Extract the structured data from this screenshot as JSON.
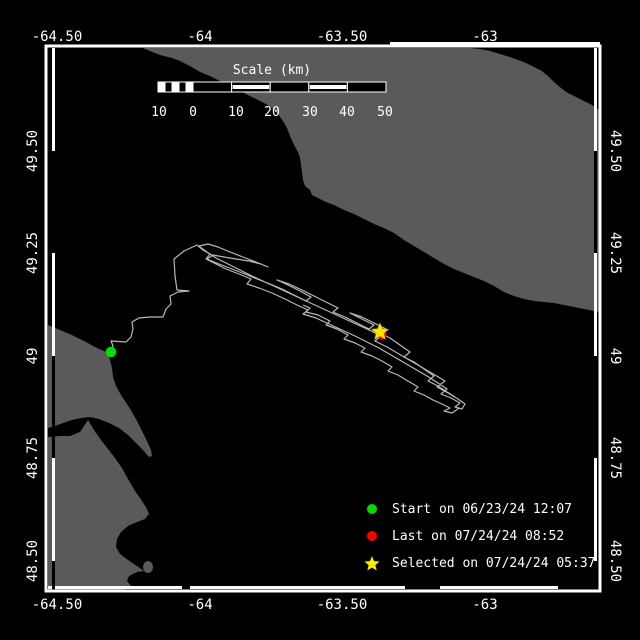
{
  "window": {
    "title": "Track map viewer"
  },
  "colors": {
    "background": "#000000",
    "water": "#000000",
    "land": "#5a5a5a",
    "border": "#ffffff",
    "track": "#b8b8b8",
    "start_marker": "#00dd00",
    "last_marker": "#ff0000",
    "selected_marker": "#ffe600",
    "text": "#ffffff"
  },
  "axis": {
    "top": [
      {
        "text": "-64.50",
        "x": 57
      },
      {
        "text": "-64",
        "x": 200
      },
      {
        "text": "-63.50",
        "x": 342
      },
      {
        "text": "-63",
        "x": 485
      }
    ],
    "bottom": [
      {
        "text": "-64.50",
        "x": 57
      },
      {
        "text": "-64",
        "x": 200
      },
      {
        "text": "-63.50",
        "x": 342
      },
      {
        "text": "-63",
        "x": 485
      }
    ],
    "left": [
      {
        "text": "49.50",
        "y": 151
      },
      {
        "text": "49.25",
        "y": 253
      },
      {
        "text": "49",
        "y": 356
      },
      {
        "text": "48.75",
        "y": 458
      },
      {
        "text": "48.50",
        "y": 561
      }
    ],
    "right": [
      {
        "text": "49.50",
        "y": 151
      },
      {
        "text": "49.25",
        "y": 253
      },
      {
        "text": "49",
        "y": 356
      },
      {
        "text": "48.75",
        "y": 458
      },
      {
        "text": "48.50",
        "y": 561
      }
    ]
  },
  "scalebar": {
    "title": "Scale (km)",
    "title_x": 272,
    "title_y": 74,
    "x1": 158,
    "zero_x": 193,
    "x2": 386,
    "y1": 82,
    "y2": 92,
    "label_y": 116,
    "labels": [
      {
        "text": "10",
        "x": 159
      },
      {
        "text": "0",
        "x": 193
      },
      {
        "text": "10",
        "x": 236
      },
      {
        "text": "20",
        "x": 272
      },
      {
        "text": "30",
        "x": 310
      },
      {
        "text": "40",
        "x": 347
      },
      {
        "text": "50",
        "x": 385
      }
    ]
  },
  "legend": {
    "marker_x": 372,
    "text_x": 392,
    "y0": 509,
    "dy": 27,
    "items": [
      {
        "marker": "circle",
        "color": "#00dd00",
        "label": "Start on 06/23/24 12:07"
      },
      {
        "marker": "circle",
        "color": "#ff0000",
        "label": "Last on 07/24/24 08:52"
      },
      {
        "marker": "star",
        "color": "#ffe600",
        "label": "Selected on 07/24/24 05:37"
      }
    ]
  },
  "markers": {
    "start": {
      "x": 111,
      "y": 352,
      "r": 5.3,
      "color": "#00dd00"
    },
    "last": {
      "x": 382,
      "y": 335,
      "r": 4.5,
      "color": "#ff0000"
    },
    "selected": {
      "x": 380,
      "y": 332,
      "r": 9,
      "color": "#ffe600"
    }
  },
  "frame": {
    "x1": 46,
    "y1": 46,
    "x2": 600,
    "y2": 591
  },
  "zebra": {
    "top": {
      "pos": 42,
      "segs": [
        [
          48,
          390,
          "#000000"
        ],
        [
          390,
          600,
          "#ffffff"
        ]
      ]
    },
    "bottom": {
      "pos": 586,
      "segs": [
        [
          48,
          182,
          "#ffffff"
        ],
        [
          182,
          190,
          "#000000"
        ],
        [
          190,
          405,
          "#ffffff"
        ],
        [
          405,
          440,
          "#000000"
        ],
        [
          440,
          558,
          "#ffffff"
        ],
        [
          558,
          600,
          "#000000"
        ]
      ]
    },
    "left": {
      "pos": 52,
      "segs": [
        [
          48,
          151,
          "#ffffff"
        ],
        [
          151,
          253,
          "#000000"
        ],
        [
          253,
          356,
          "#ffffff"
        ],
        [
          356,
          458,
          "#000000"
        ],
        [
          458,
          561,
          "#ffffff"
        ],
        [
          561,
          590,
          "#000000"
        ]
      ]
    },
    "right": {
      "pos": 594,
      "segs": [
        [
          48,
          151,
          "#ffffff"
        ],
        [
          151,
          253,
          "#000000"
        ],
        [
          253,
          356,
          "#ffffff"
        ],
        [
          356,
          458,
          "#000000"
        ],
        [
          458,
          561,
          "#ffffff"
        ],
        [
          561,
          590,
          "#000000"
        ]
      ]
    }
  },
  "land_polygons": [
    [
      [
        143,
        48
      ],
      [
        150,
        51
      ],
      [
        160,
        55
      ],
      [
        172,
        58
      ],
      [
        180,
        61
      ],
      [
        190,
        66
      ],
      [
        200,
        72
      ],
      [
        212,
        77
      ],
      [
        224,
        83
      ],
      [
        236,
        89
      ],
      [
        248,
        95
      ],
      [
        258,
        100
      ],
      [
        266,
        104
      ],
      [
        272,
        108
      ],
      [
        278,
        114
      ],
      [
        283,
        121
      ],
      [
        287,
        128
      ],
      [
        290,
        136
      ],
      [
        294,
        145
      ],
      [
        298,
        152
      ],
      [
        300,
        158
      ],
      [
        301,
        165
      ],
      [
        302,
        172
      ],
      [
        303,
        180
      ],
      [
        305,
        186
      ],
      [
        310,
        190
      ],
      [
        312,
        195
      ],
      [
        318,
        198
      ],
      [
        326,
        202
      ],
      [
        334,
        205
      ],
      [
        344,
        210
      ],
      [
        354,
        214
      ],
      [
        364,
        219
      ],
      [
        374,
        224
      ],
      [
        384,
        228
      ],
      [
        394,
        233
      ],
      [
        404,
        240
      ],
      [
        414,
        246
      ],
      [
        424,
        252
      ],
      [
        434,
        258
      ],
      [
        444,
        264
      ],
      [
        454,
        269
      ],
      [
        464,
        273
      ],
      [
        474,
        277
      ],
      [
        484,
        281
      ],
      [
        494,
        286
      ],
      [
        504,
        292
      ],
      [
        514,
        296
      ],
      [
        524,
        299
      ],
      [
        534,
        301
      ],
      [
        544,
        302
      ],
      [
        554,
        303
      ],
      [
        564,
        305
      ],
      [
        574,
        307
      ],
      [
        584,
        309
      ],
      [
        594,
        311
      ],
      [
        599,
        312
      ],
      [
        599,
        110
      ],
      [
        592,
        105
      ],
      [
        584,
        101
      ],
      [
        576,
        97
      ],
      [
        568,
        93
      ],
      [
        561,
        88
      ],
      [
        554,
        82
      ],
      [
        548,
        76
      ],
      [
        542,
        71
      ],
      [
        534,
        67
      ],
      [
        526,
        63
      ],
      [
        518,
        60
      ],
      [
        510,
        57
      ],
      [
        500,
        54
      ],
      [
        490,
        51
      ],
      [
        480,
        49
      ],
      [
        470,
        48
      ]
    ],
    [
      [
        48,
        325
      ],
      [
        60,
        330
      ],
      [
        72,
        335
      ],
      [
        84,
        341
      ],
      [
        95,
        347
      ],
      [
        104,
        351
      ],
      [
        108,
        354
      ],
      [
        110,
        360
      ],
      [
        112,
        368
      ],
      [
        113,
        377
      ],
      [
        116,
        386
      ],
      [
        121,
        395
      ],
      [
        127,
        404
      ],
      [
        132,
        412
      ],
      [
        137,
        421
      ],
      [
        142,
        431
      ],
      [
        147,
        441
      ],
      [
        151,
        450
      ],
      [
        152,
        456
      ],
      [
        149,
        457
      ],
      [
        143,
        450
      ],
      [
        136,
        443
      ],
      [
        128,
        435
      ],
      [
        119,
        428
      ],
      [
        109,
        423
      ],
      [
        99,
        419
      ],
      [
        90,
        417
      ],
      [
        81,
        418
      ],
      [
        72,
        420
      ],
      [
        63,
        423
      ],
      [
        55,
        426
      ],
      [
        48,
        428
      ]
    ],
    [
      [
        48,
        437
      ],
      [
        60,
        436
      ],
      [
        70,
        436
      ],
      [
        80,
        432
      ],
      [
        88,
        420
      ],
      [
        94,
        430
      ],
      [
        101,
        440
      ],
      [
        108,
        449
      ],
      [
        115,
        458
      ],
      [
        122,
        468
      ],
      [
        128,
        479
      ],
      [
        135,
        491
      ],
      [
        142,
        501
      ],
      [
        147,
        509
      ],
      [
        149,
        514
      ],
      [
        145,
        519
      ],
      [
        137,
        522
      ],
      [
        128,
        526
      ],
      [
        121,
        532
      ],
      [
        117,
        539
      ],
      [
        116,
        547
      ],
      [
        120,
        554
      ],
      [
        128,
        560
      ],
      [
        137,
        566
      ],
      [
        144,
        571
      ],
      [
        137,
        572
      ],
      [
        129,
        576
      ],
      [
        127,
        581
      ],
      [
        131,
        586
      ],
      [
        126,
        589
      ],
      [
        115,
        591
      ],
      [
        48,
        591
      ]
    ]
  ],
  "island": {
    "cx": 148,
    "cy": 567,
    "rx": 5,
    "ry": 6
  },
  "track": {
    "color": "#b8b8b8",
    "strands": [
      [
        [
          111,
          352
        ],
        [
          113,
          346
        ],
        [
          111,
          341
        ],
        [
          126,
          342
        ],
        [
          131,
          337
        ],
        [
          133,
          329
        ],
        [
          132,
          322
        ],
        [
          139,
          318
        ],
        [
          150,
          317
        ],
        [
          163,
          317
        ],
        [
          166,
          309
        ],
        [
          171,
          304
        ],
        [
          170,
          296
        ],
        [
          178,
          292
        ],
        [
          189,
          291
        ],
        [
          177,
          290
        ],
        [
          175,
          276
        ],
        [
          174,
          259
        ],
        [
          184,
          251
        ],
        [
          197,
          245
        ]
      ],
      [
        [
          197,
          245
        ],
        [
          203,
          250
        ],
        [
          210,
          254
        ],
        [
          206,
          259
        ],
        [
          214,
          263
        ],
        [
          226,
          269
        ],
        [
          239,
          274
        ],
        [
          251,
          279
        ],
        [
          247,
          284
        ],
        [
          259,
          288
        ],
        [
          272,
          293
        ],
        [
          285,
          299
        ],
        [
          297,
          305
        ],
        [
          308,
          310
        ],
        [
          303,
          314
        ],
        [
          316,
          318
        ],
        [
          329,
          324
        ],
        [
          342,
          330
        ],
        [
          355,
          336
        ],
        [
          367,
          342
        ],
        [
          379,
          348
        ],
        [
          391,
          355
        ],
        [
          403,
          362
        ],
        [
          415,
          369
        ],
        [
          427,
          376
        ],
        [
          438,
          383
        ],
        [
          447,
          389
        ],
        [
          441,
          394
        ],
        [
          451,
          398
        ],
        [
          460,
          403
        ],
        [
          455,
          407
        ],
        [
          462,
          409
        ],
        [
          465,
          404
        ],
        [
          458,
          399
        ],
        [
          448,
          393
        ],
        [
          437,
          387
        ],
        [
          445,
          381
        ],
        [
          435,
          375
        ],
        [
          423,
          368
        ],
        [
          411,
          361
        ],
        [
          399,
          354
        ],
        [
          387,
          347
        ],
        [
          375,
          341
        ],
        [
          381,
          336
        ],
        [
          369,
          330
        ],
        [
          356,
          324
        ],
        [
          343,
          318
        ],
        [
          330,
          312
        ],
        [
          317,
          306
        ],
        [
          304,
          300
        ],
        [
          291,
          294
        ],
        [
          278,
          288
        ],
        [
          265,
          282
        ],
        [
          252,
          276
        ],
        [
          240,
          270
        ],
        [
          228,
          264
        ],
        [
          216,
          258
        ],
        [
          207,
          252
        ],
        [
          200,
          247
        ]
      ],
      [
        [
          199,
          246
        ],
        [
          208,
          244
        ],
        [
          218,
          247
        ],
        [
          230,
          252
        ],
        [
          243,
          257
        ],
        [
          256,
          262
        ],
        [
          268,
          267
        ],
        [
          261,
          264
        ],
        [
          249,
          261
        ],
        [
          236,
          259
        ],
        [
          224,
          257
        ],
        [
          213,
          255
        ],
        [
          207,
          259
        ],
        [
          219,
          264
        ],
        [
          232,
          269
        ],
        [
          245,
          274
        ],
        [
          257,
          279
        ],
        [
          270,
          284
        ],
        [
          282,
          289
        ],
        [
          294,
          295
        ],
        [
          306,
          301
        ],
        [
          311,
          297
        ],
        [
          300,
          291
        ],
        [
          288,
          285
        ],
        [
          277,
          280
        ],
        [
          289,
          284
        ],
        [
          302,
          290
        ],
        [
          314,
          296
        ],
        [
          326,
          302
        ],
        [
          338,
          308
        ],
        [
          333,
          312
        ],
        [
          345,
          317
        ],
        [
          357,
          323
        ],
        [
          369,
          329
        ],
        [
          374,
          325
        ],
        [
          362,
          319
        ],
        [
          350,
          313
        ],
        [
          362,
          317
        ],
        [
          374,
          323
        ],
        [
          386,
          329
        ],
        [
          380,
          333
        ],
        [
          390,
          338
        ],
        [
          400,
          345
        ],
        [
          410,
          352
        ],
        [
          404,
          357
        ],
        [
          414,
          362
        ],
        [
          424,
          369
        ],
        [
          434,
          376
        ],
        [
          428,
          381
        ],
        [
          438,
          386
        ],
        [
          447,
          392
        ],
        [
          455,
          397
        ]
      ],
      [
        [
          303,
          305
        ],
        [
          310,
          308
        ],
        [
          306,
          312
        ],
        [
          318,
          315
        ],
        [
          330,
          321
        ],
        [
          326,
          325
        ],
        [
          337,
          329
        ],
        [
          348,
          335
        ],
        [
          344,
          339
        ],
        [
          355,
          343
        ],
        [
          365,
          348
        ],
        [
          361,
          352
        ],
        [
          372,
          356
        ],
        [
          382,
          361
        ],
        [
          392,
          367
        ],
        [
          388,
          371
        ],
        [
          398,
          375
        ],
        [
          408,
          381
        ],
        [
          418,
          387
        ],
        [
          414,
          391
        ],
        [
          424,
          395
        ],
        [
          433,
          400
        ],
        [
          442,
          404
        ],
        [
          450,
          408
        ],
        [
          444,
          411
        ],
        [
          452,
          413
        ],
        [
          459,
          408
        ]
      ]
    ]
  }
}
